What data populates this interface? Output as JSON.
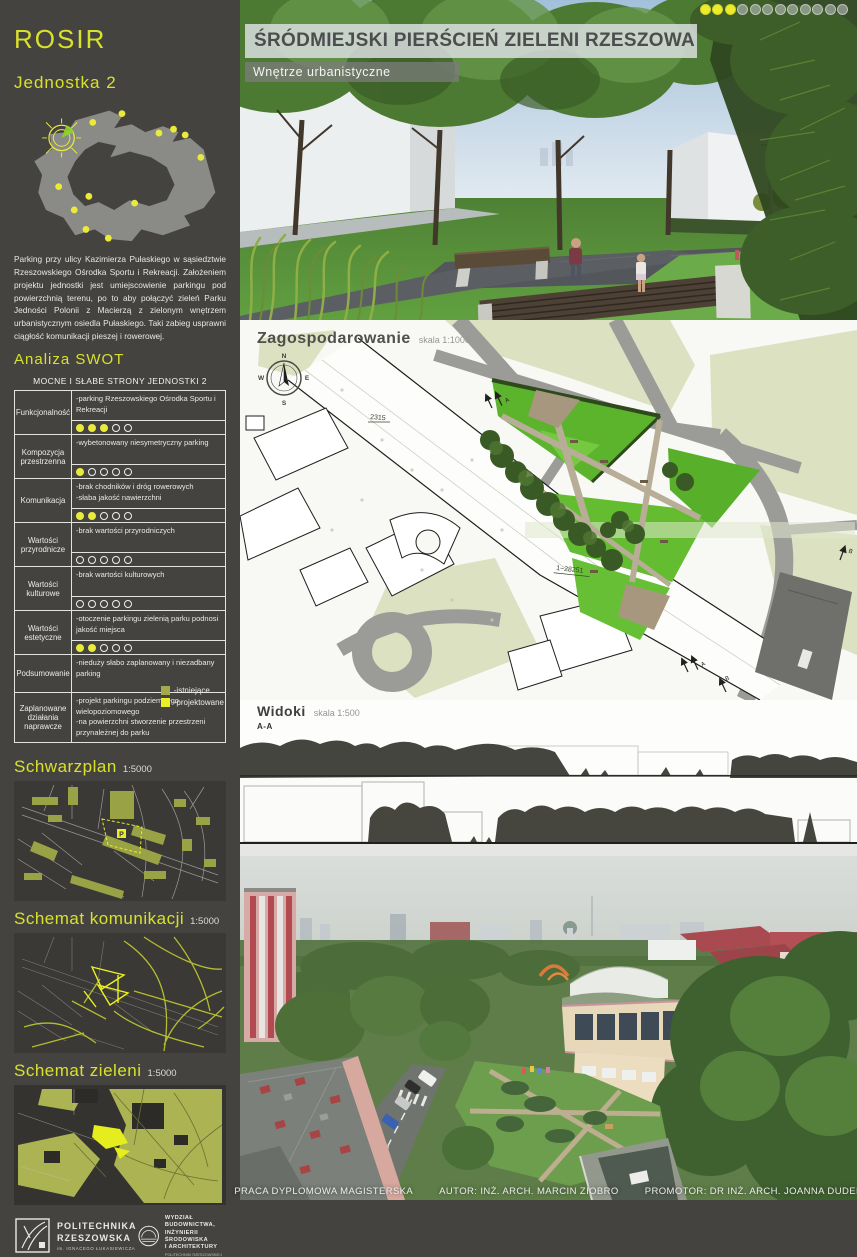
{
  "poster": {
    "title": "ŚRÓDMIEJSKI PIERŚCIEŃ ZIELENI RZESZOWA",
    "subtitle": "Wnętrze urbanistyczne",
    "pagination": {
      "filled": 3,
      "total": 12
    }
  },
  "colors": {
    "accent_yellow": "#d8e12c",
    "bright_yellow": "#e8ef25",
    "olive_existing": "#a3aa4b",
    "sidebar_background": "#454340"
  },
  "sidebar": {
    "logo": "ROSIR",
    "unit": "Jednostka 2",
    "description": "Parking przy ulicy Kazimierza Pułaskiego w sąsiedztwie Rzeszowskiego Ośrodka Sportu i Rekreacji. Założeniem projektu jednostki jest umiejscowienie parkingu pod powierzchnią terenu, po to aby połączyć zieleń Parku Jedności Polonii z Macierzą z zielonym wnętrzem urbanistycznym osiedla Pułaskiego. Taki zabieg usprawni ciągłość komunikacji pieszej i rowerowej.",
    "swot_heading": "Analiza SWOT",
    "swot": {
      "table_title": "MOCNE I SŁABE STRONY JEDNOSTKI 2",
      "rows": [
        {
          "category": "Funkcjonalność",
          "text": "-parking Rzeszowskiego Ośrodka Sportu i Rekreacji",
          "rating": {
            "filled": 3,
            "total": 5
          }
        },
        {
          "category": "Kompozycja przestrzenna",
          "text": "-wybetonowany niesymetryczny parking",
          "rating": {
            "filled": 1,
            "total": 5
          }
        },
        {
          "category": "Komunikacja",
          "text": "-brak chodników i dróg rowerowych\n-słaba jakość nawierzchni",
          "rating": {
            "filled": 2,
            "total": 5
          }
        },
        {
          "category": "Wartości przyrodnicze",
          "text": "-brak wartości  przyrodniczych",
          "rating": {
            "filled": 0,
            "total": 5
          }
        },
        {
          "category": "Wartości kulturowe",
          "text": "-brak wartości  kulturowych",
          "rating": {
            "filled": 0,
            "total": 5
          }
        },
        {
          "category": "Wartości estetyczne",
          "text": "-otoczenie parkingu zielenią parku podnosi jakość miejsca",
          "rating": {
            "filled": 2,
            "total": 5
          }
        },
        {
          "category": "Podsumowanie",
          "text": "-nieduży słabo zaplanowany i niezadbany parking",
          "rating": null
        },
        {
          "category": "Zaplanowane działania naprawcze",
          "text": "-projekt parkingu podziemnego wielopoziomowego\n-na powierzchni stworzenie przestrzeni przynależnej do parku",
          "rating": null
        }
      ]
    },
    "legend": {
      "existing": "-istniejące",
      "designed": "-projektowane"
    },
    "sections": [
      {
        "title": "Schwarzplan",
        "scale": "1:5000"
      },
      {
        "title": "Schemat komunikacji",
        "scale": "1:5000"
      },
      {
        "title": "Schemat zieleni",
        "scale": "1:5000"
      }
    ],
    "parking_marker": "P"
  },
  "plan": {
    "title": "Zagospodarowanie",
    "scale": "skala 1:1000",
    "compass": {
      "n": "N",
      "e": "E",
      "s": "S",
      "w": "W"
    },
    "labels": {
      "dim1": "2315",
      "dim2": "1−28251"
    },
    "markers": {
      "a": "A",
      "b": "B"
    }
  },
  "widoki": {
    "title": "Widoki",
    "scale": "skala 1:500",
    "section_a": "A-A",
    "section_b": "B-B"
  },
  "footer": {
    "work_type": "PRACA DYPLOMOWA MAGISTERSKA",
    "author": "AUTOR: INŻ. ARCH. MARCIN ZIOBRO",
    "promoter": "PROMOTOR: DR INŻ. ARCH. JOANNA DUDEK"
  },
  "logos": {
    "university": {
      "name_line1": "POLITECHNIKA",
      "name_line2": "RZESZOWSKA",
      "sub": "im. IGNACEGO ŁUKASIEWICZA"
    },
    "faculty": {
      "line1": "WYDZIAŁ",
      "line2": "BUDOWNICTWA,",
      "line3": "INŻYNIERII ŚRODOWISKA",
      "line4": "I ARCHITEKTURY",
      "sub": "POLITECHNIKI RZESZOWSKIEJ"
    }
  }
}
